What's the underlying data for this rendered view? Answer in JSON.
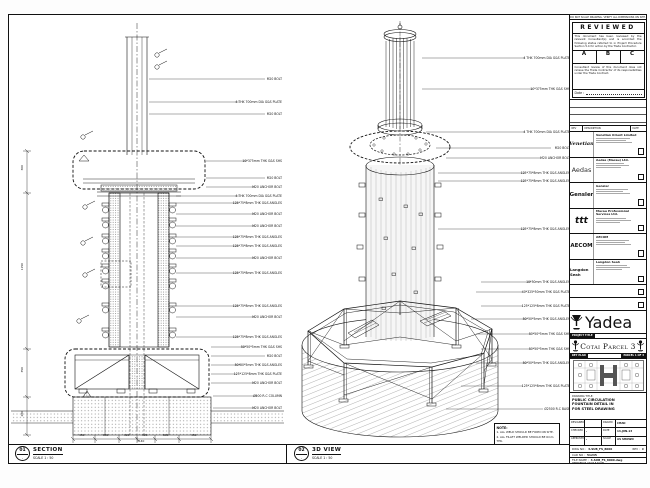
{
  "view_section": {
    "bubble": "01",
    "title": "SECTION",
    "scale": "SCALE 1 : 50",
    "callouts": [
      "M20 BOLT",
      "4 THK 700mm DIA G&S PLATE",
      "M20 BOLT",
      "10*375mm THK G&S SHS",
      "M20 BOLT",
      "M20 ANCHOR BOLT",
      "4 THK 700mm DIA G&S PLATE",
      "125*75*8mm THK G&S ANGLES",
      "M20 ANCHOR BOLT",
      "M20 ANCHOR BOLT",
      "125*75*8mm THK G&S ANGLES",
      "125*75*8mm THK G&S ANGLES",
      "M20 ANCHOR BOLT",
      "125*75*8mm THK G&S ANGLES",
      "125*75*8mm THK G&S ANGLES",
      "M20 ANCHOR BOLT",
      "125*75*8mm THK G&S ANGLES",
      "50*50*5mm THK G&S SHS",
      "M20 BOLT",
      "50*50*5mm THK G&S ANGLES",
      "125*125*8mm THK G&S PLATE",
      "M20 ANCHOR BOLT",
      "Ø500 R.C COLUMN",
      "M20 ANCHOR BOLT"
    ]
  },
  "view_iso": {
    "bubble": "02",
    "title": "3D VIEW",
    "scale": "SCALE 1 : 50",
    "callouts": [
      "4 THK 700mm DIA G&S PLATE",
      "10*375mm THK G&S SHS",
      "4 THK 700mm DIA G&S PLATE",
      "M20 BOLT",
      "M20 ANCHOR BOLT",
      "125*75*8mm THK G&S ANGLES",
      "125*75*8mm THK G&S ANGLES",
      "125*75*8mm THK G&S ANGLES",
      "10*50mm THK G&S ANGLES",
      "40*325*50mm THK G&S PLATE",
      "125*125*8mm THK G&S PLATE",
      "50*50*5mm THK G&S ANGLES",
      "50*50*5mm THK G&S SHS",
      "50*50*5mm THK G&S SHS",
      "50*50*5mm THK G&S ANGLES",
      "125*125*8mm THK G&S PLATE",
      "Ø2500 R.C BASE"
    ]
  },
  "notes": {
    "heading": "NOTE:",
    "line1": "1. ALL WELD SHOULD BE FORM ON SITE.",
    "line2": "2. ALL FILLET WELDED SHOULD BE 6mm THK."
  },
  "dims": {
    "bottom": [
      "450",
      "800",
      "320",
      "320",
      "800",
      "450"
    ],
    "bottom_total": "3140",
    "left": [
      "300",
      "1150",
      "350",
      "280"
    ]
  },
  "title_block": {
    "no_scale_strip": "DO NOT SCALE DRAWING. VERIFY ALL DIMENSIONS ON SITE.",
    "stamp": {
      "title": "REVIEWED",
      "para1": "This document has been reviewed by the relevant Consultant(s) and is accorded the following status referred to in Project Procedure Section 5.4 for action by the Trade Contractor.",
      "grade_a": "A",
      "grade_b": "B",
      "grade_c": "C",
      "para2": "Consultant review of this document does not relieve the Trade Contractor of its responsibilities under the Trade Contract.",
      "date_label": "Date :"
    },
    "rev_header": {
      "col1": "REV",
      "col2": "DESCRIPTION",
      "col3": "DATE"
    },
    "consultants": [
      {
        "logo": "Venetian",
        "name": "Venetian Orient Limited"
      },
      {
        "logo": "Aedas",
        "name": "Aedas (Macau) Ltd."
      },
      {
        "logo": "Gensler",
        "name": "Gensler"
      },
      {
        "logo": "ttt",
        "name": "Macau Professional Services Ltd."
      },
      {
        "logo": "AECOM",
        "name": "AECOM"
      },
      {
        "logo": "Langdon Seah",
        "name": "Langdon Seah"
      }
    ],
    "contractor": {
      "name": "Yadea Construction (Macau) CO., LTD."
    },
    "project_title_label": "PROJECT TITLE",
    "project_title": "Cotai Parcel 3",
    "key_plan_label": "KEY PLAN",
    "key_plan_ref": "PARCEL 1 OF 3",
    "drawing_title_label": "DRAWING TITLE:",
    "drawing_title_line1": "PUBLIC CIRCULATION",
    "drawing_title_line2": "FOUNTAIN DETAIL IN",
    "drawing_title_line3": "FOR STEEL DRAWING",
    "fields": {
      "designed_label": "DESIGNED",
      "designed": "",
      "drawn_label": "DRAWN",
      "drawn": "CHAD",
      "checked_label": "CHECKED",
      "checked": "-",
      "date_label": "DATE",
      "date": "14-JUN-13",
      "approved_label": "APPROVED",
      "approved": "-",
      "scale_label": "SCALE",
      "scale": "AS SHOWN"
    },
    "dwg_no_label": "DWG NO :",
    "dwg_no": "3-SUB_FS_8000",
    "rev_label": "REV :",
    "rev": "C",
    "cad_no_label": "CAD NO :",
    "cad_no": "51245",
    "file_label": "FILE NAME :",
    "file": "3-SUB_FS_8000.dwg",
    "ref_note": "REFERENCE ON FILE NAME"
  }
}
